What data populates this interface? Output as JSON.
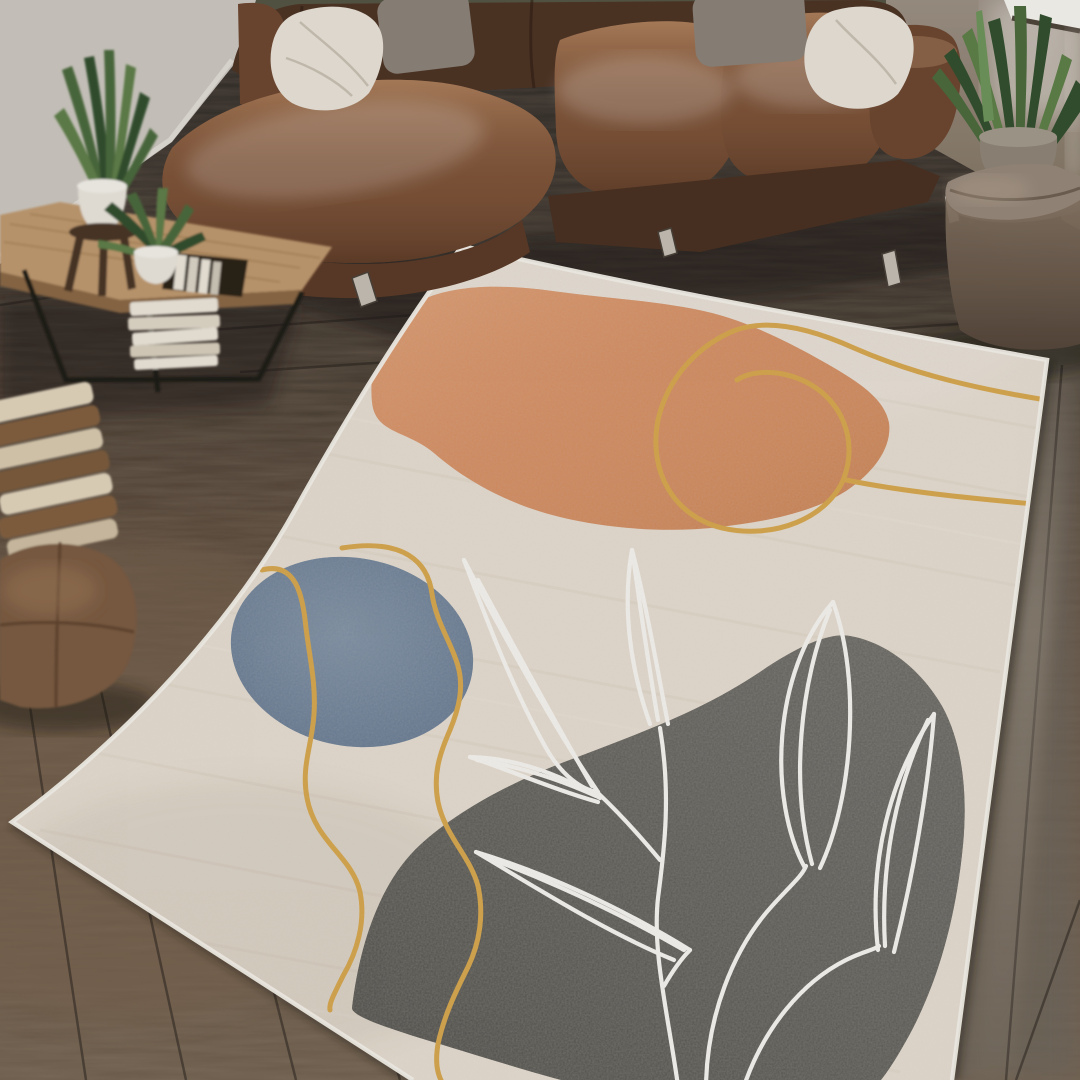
{
  "meta": {
    "description": "Lifestyle product photograph of an abstract mid-century boho area rug staged in a living room with a brown leather sectional sofa, wood coffee table, plants and poufs on dark hardwood flooring",
    "image_type": "photograph",
    "visible_text": ""
  },
  "scene": {
    "room": "living-room",
    "objects": [
      "area-rug",
      "leather-sectional-sofa",
      "white-throw-pillow-left",
      "gray-throw-pillow-left",
      "gray-throw-pillow-right",
      "white-throw-pillow-right",
      "wood-coffee-table",
      "magazine-books",
      "aloe-plant",
      "small-succulent-plant",
      "white-plant-pot",
      "plant-stool",
      "stacked-books-floor",
      "leather-pouf-left",
      "snake-plant",
      "snake-plant-pot",
      "suede-pouf-right",
      "window-light",
      "hardwood-floor",
      "wall"
    ]
  },
  "rug": {
    "style": "abstract organic shapes with botanical line art",
    "elements": [
      "cream field",
      "terracotta blob",
      "slate blue circle",
      "charcoal blob",
      "gold contour lines",
      "white outline leaves"
    ],
    "colors": {
      "base": "#E9E0D4",
      "binding": "#F6F2EB",
      "orange": "#D98C5C",
      "blue": "#6B8099",
      "gray": "#5D5C58",
      "gold": "#D9A84C",
      "leaf_white": "#FAF8F4"
    }
  },
  "palette": {
    "wall_left": "#CDC8C1",
    "wall_right": "#93867A",
    "window_light": "#F7F5F0",
    "floor_base": "#59493B",
    "sofa_leather": "#7A5138",
    "sofa_dark": "#4A3121",
    "sofa_back": "#4E3425",
    "sofa_arm": "#6E4730",
    "pillow_white": "#E9E3D9",
    "pillow_gray": "#8C8379",
    "table_wood": "#C09A6F",
    "table_edge": "#8A6845",
    "plant_green": "#4C6B3D",
    "plant_green_dark": "#33502E",
    "pot_white": "#EAE6DD",
    "stool_brown": "#4A3526",
    "stack_cream": "#E2D5BD",
    "stack_brown": "#83603F",
    "pouf_left": "#7C5C42",
    "pouf_right_top": "#97887A",
    "pouf_right_front": "#6E5C4C",
    "metal_leg": "#C6BFB5",
    "book_white": "#ECE6DA"
  }
}
